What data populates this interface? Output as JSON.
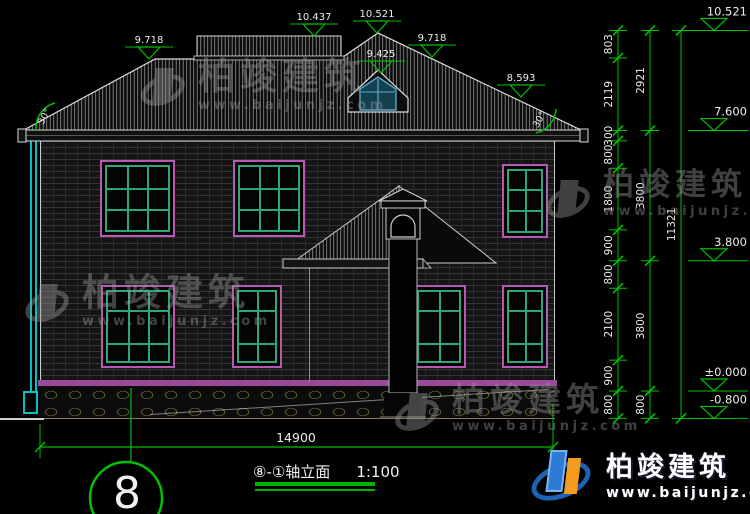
{
  "brand": {
    "name": "柏竣建筑",
    "url": "www.baijunjz.com"
  },
  "title": {
    "name": "⑧-①轴立面",
    "scale": "1:100"
  },
  "axis": {
    "label": "8"
  },
  "dims": {
    "total_width": "14900",
    "angle_left": "30°",
    "angle_right": "30°",
    "overall_height": "11321",
    "roof_markers": [
      {
        "label": "9.718",
        "x": 149,
        "y": 59
      },
      {
        "label": "10.437",
        "x": 314,
        "y": 36
      },
      {
        "label": "10.521",
        "x": 377,
        "y": 33
      },
      {
        "label": "9.425",
        "x": 381,
        "y": 73
      },
      {
        "label": "9.718",
        "x": 432,
        "y": 57
      },
      {
        "label": "8.593",
        "x": 521,
        "y": 97
      }
    ],
    "elevations": [
      {
        "label": "10.521",
        "level": 10521
      },
      {
        "label": "7.600",
        "level": 7600
      },
      {
        "label": "3.800",
        "level": 3800
      },
      {
        "label": "±0.000",
        "level": 0
      },
      {
        "label": "-0.800",
        "level": -800
      }
    ],
    "columns": [
      {
        "x": 618,
        "boundaries": [
          -800,
          0,
          900,
          3000,
          3800,
          4700,
          6500,
          7300,
          7600,
          9718,
          10521
        ],
        "labels": [
          "800",
          "900",
          "2100",
          "800",
          "900",
          "1800",
          "800",
          "300",
          "2119",
          "803"
        ]
      },
      {
        "x": 650,
        "boundaries": [
          -800,
          0,
          3800,
          7600,
          10521
        ],
        "labels": [
          "800",
          "3800",
          "3800",
          "2921"
        ]
      },
      {
        "x": 681,
        "boundaries": [
          -800,
          10521
        ],
        "labels": [
          "11321"
        ]
      }
    ]
  },
  "drawing": {
    "windows": [
      {
        "x": 100,
        "y": 160,
        "w": 75,
        "h": 77,
        "cols": [
          0.33,
          0.66
        ],
        "rows": [
          0.33,
          0.66
        ]
      },
      {
        "x": 233,
        "y": 160,
        "w": 72,
        "h": 77,
        "cols": [
          0.33,
          0.66
        ],
        "rows": [
          0.33,
          0.66
        ]
      },
      {
        "x": 502,
        "y": 164,
        "w": 46,
        "h": 74,
        "cols": [
          0.5
        ],
        "rows": [
          0.3,
          0.65
        ]
      },
      {
        "x": 101,
        "y": 285,
        "w": 74,
        "h": 83,
        "cols": [
          0.33,
          0.66
        ],
        "rows": [
          0.26,
          0.74
        ]
      },
      {
        "x": 232,
        "y": 285,
        "w": 50,
        "h": 83,
        "cols": [
          0.5
        ],
        "rows": [
          0.26,
          0.74
        ]
      },
      {
        "x": 412,
        "y": 285,
        "w": 54,
        "h": 83,
        "cols": [
          0.5
        ],
        "rows": [
          0.26,
          0.74
        ]
      },
      {
        "x": 502,
        "y": 285,
        "w": 46,
        "h": 83,
        "cols": [
          0.5
        ],
        "rows": [
          0.26,
          0.74
        ]
      }
    ]
  }
}
